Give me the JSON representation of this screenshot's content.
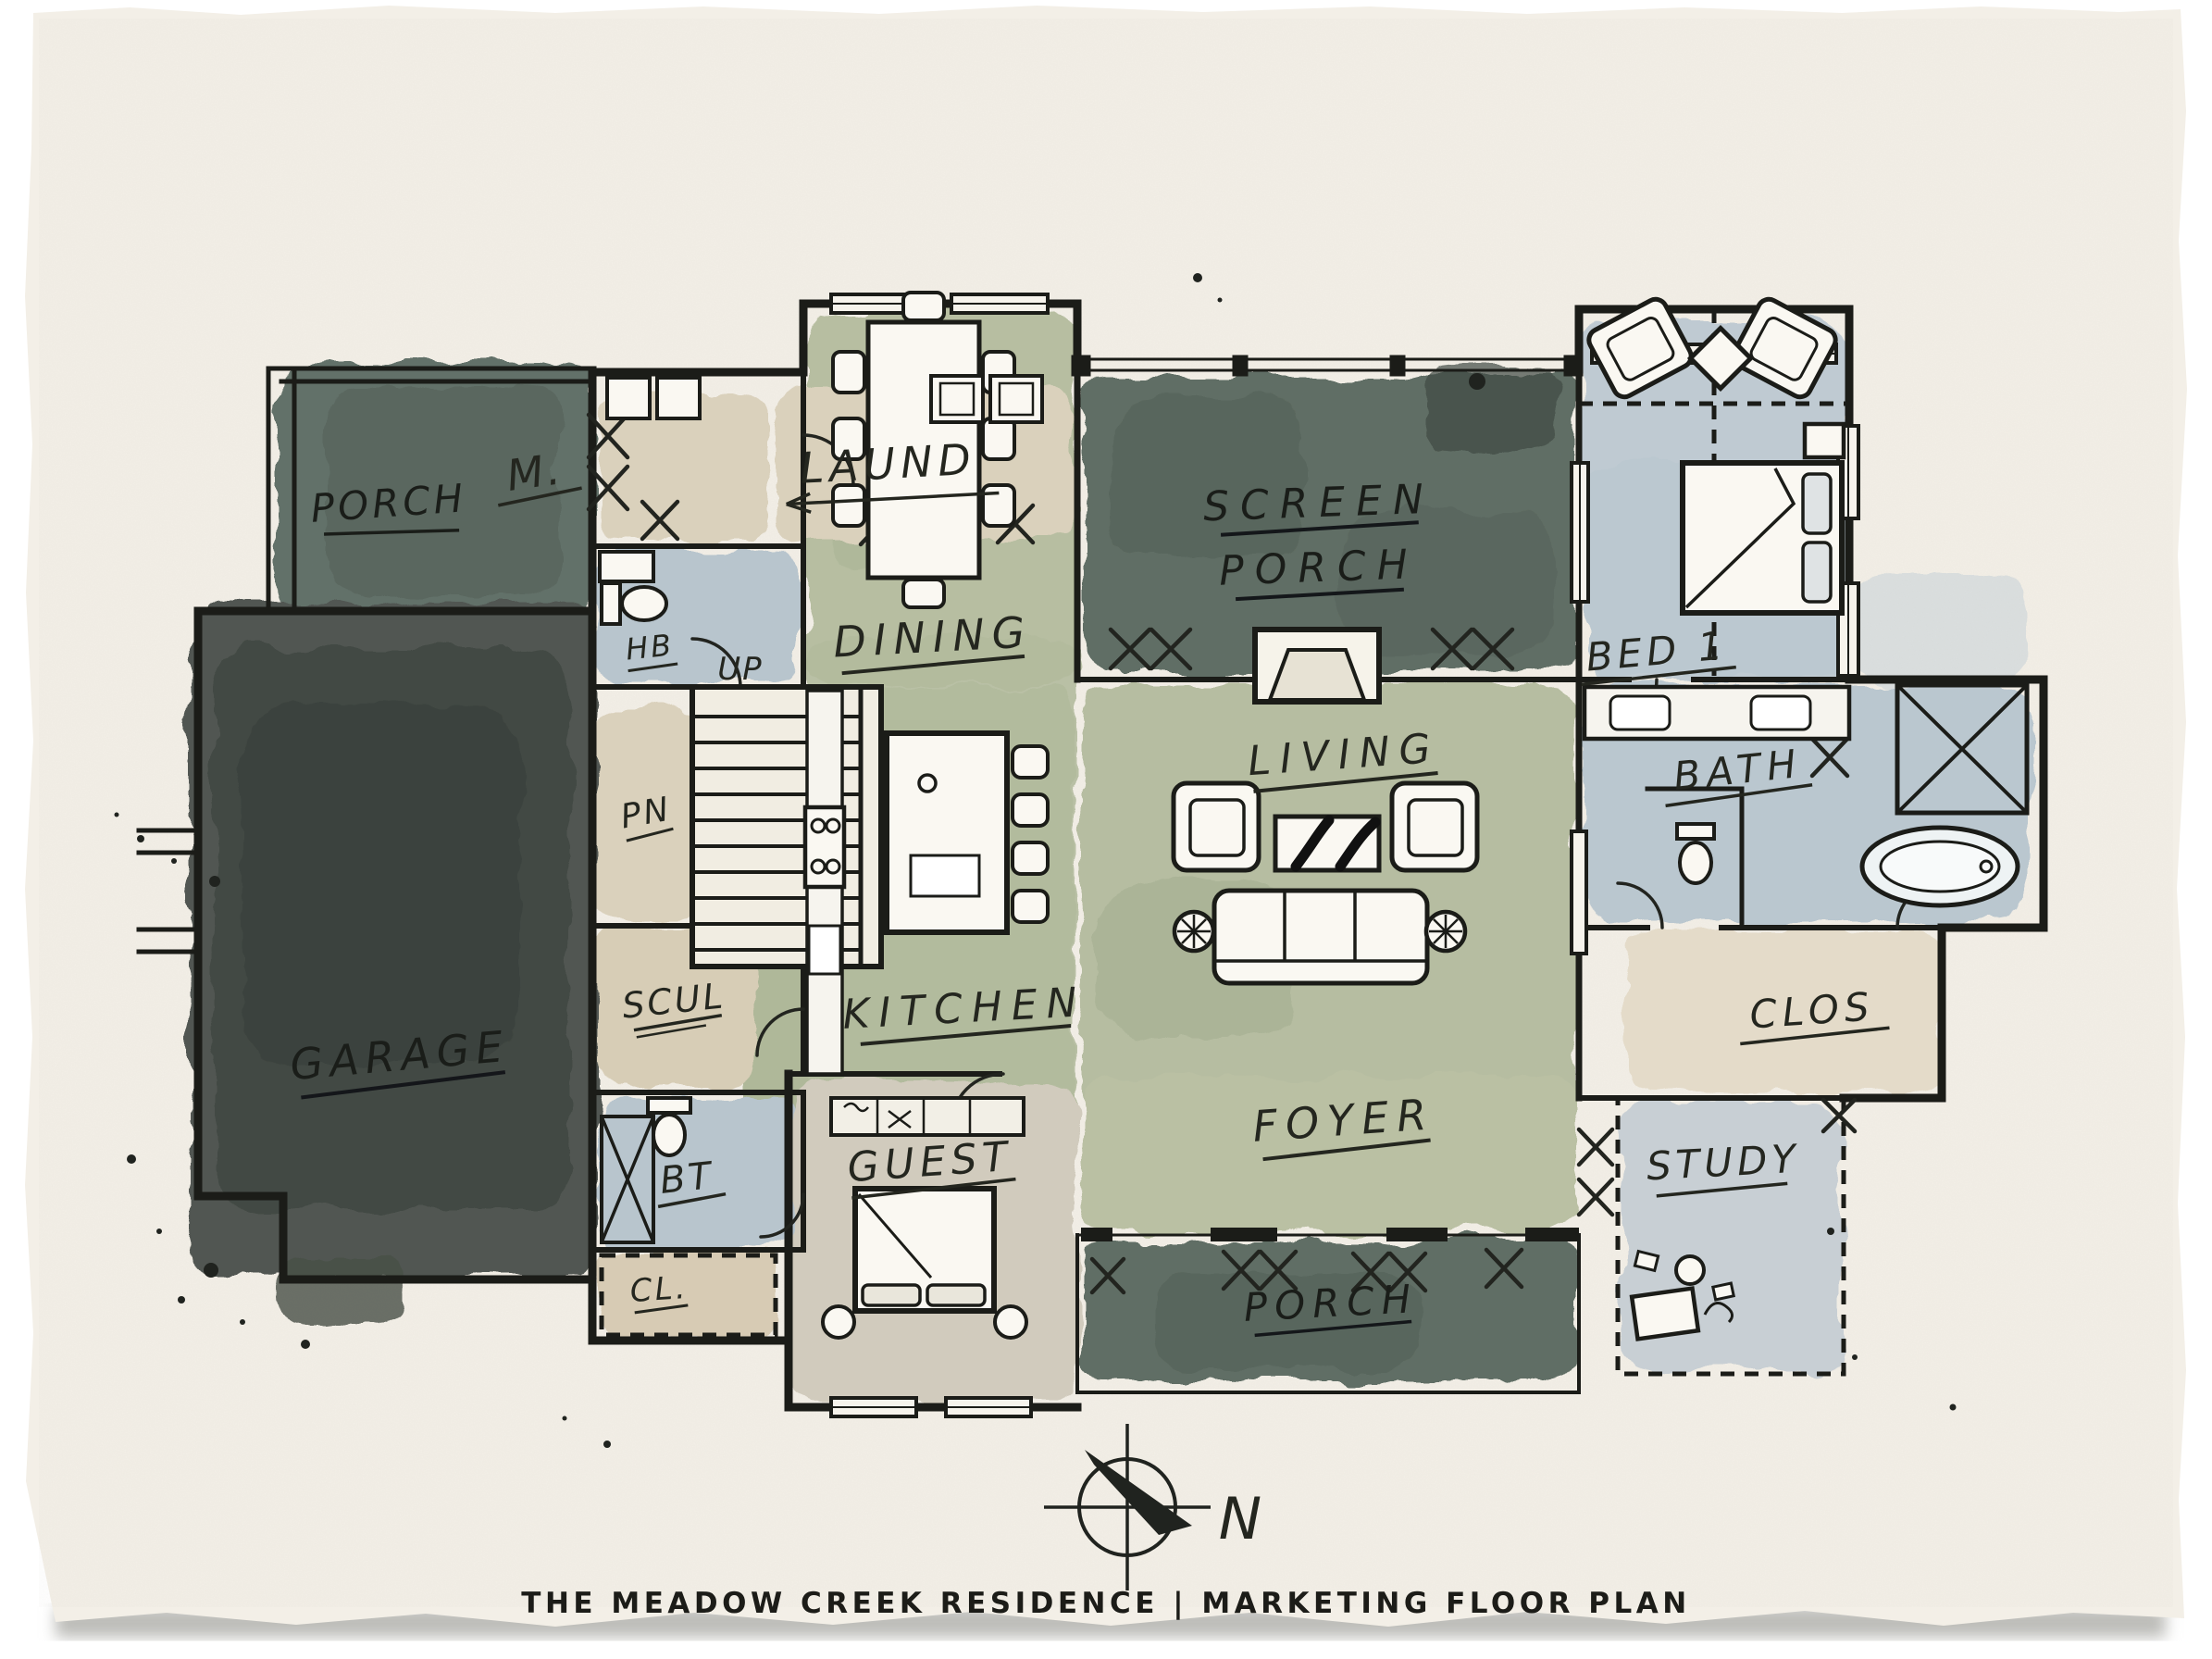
{
  "title": "THE MEADOW CREEK RESIDENCE | MARKETING FLOOR PLAN",
  "compass": {
    "north_label": "N"
  },
  "rooms": {
    "porch_upper": "PORCH",
    "mud": "M.",
    "laundry": "LAUND",
    "half_bath": "HB",
    "stair_direction": "UP",
    "pantry": "PN",
    "dining": "DINING",
    "screen_porch_line1": "SCREEN",
    "screen_porch_line2": "PORCH",
    "bed1": "BED 1",
    "living": "LIVING",
    "bath": "BATH",
    "garage": "GARAGE",
    "scullery": "SCUL",
    "kitchen": "KITCHEN",
    "closet": "CLOS",
    "bath2": "BT",
    "guest": "GUEST",
    "foyer": "FOYER",
    "study": "STUDY",
    "closet2": "CL.",
    "porch_lower": "PORCH"
  },
  "palette": {
    "paper": "#f3efe7",
    "ink": "#1b1c18",
    "wash_dark_green": "#57655b",
    "wash_sage": "#b2ba9c",
    "wash_blue": "#b9c6cf",
    "wash_tan": "#d9cfba",
    "wash_cream": "#e3dac7",
    "wash_charcoal": "#3a403b",
    "wash_warm_gray": "#cfc9bb"
  }
}
